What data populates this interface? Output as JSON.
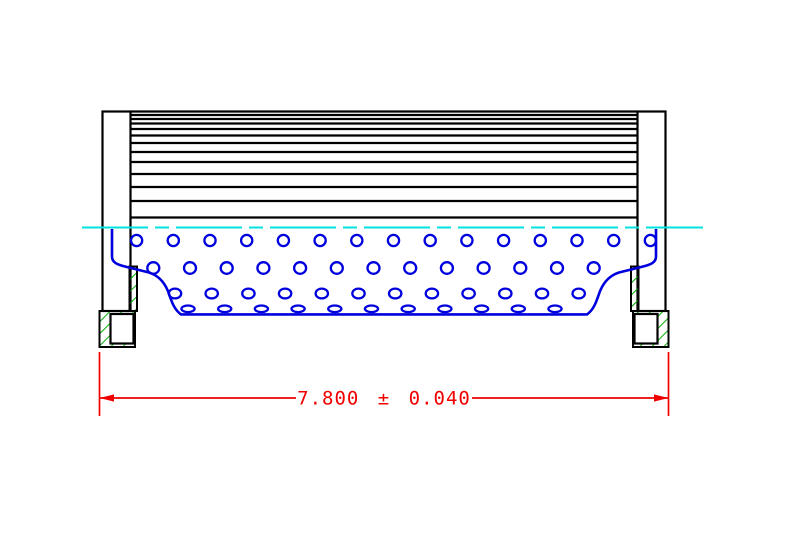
{
  "drawing": {
    "type": "technical-cad-cross-section",
    "subject": "filter-element-side-section-view",
    "dimension": {
      "label": "7.800 ± 0.040",
      "nominal": "7.800",
      "tolerance": "0.040"
    },
    "colors": {
      "black": "#000000",
      "blue": "#0000DE",
      "cyan": "#00E1E1",
      "green": "#00AE00",
      "red": "#F10000",
      "bg": "#FFFFFF"
    },
    "pleat_lines": {
      "x1": 130.5,
      "x2": 637.5,
      "ys": [
        111.5,
        115,
        119,
        123.5,
        129,
        135.5,
        143,
        152,
        162,
        174,
        187,
        201,
        217.5
      ]
    },
    "hole_rows": [
      {
        "y": 240.5,
        "rx": 5.6,
        "ry": 5.6,
        "x_start": 136.6,
        "spacing": 36.7,
        "count": 15
      },
      {
        "y": 268.0,
        "rx": 6.0,
        "ry": 5.8,
        "x_start": 153.3,
        "spacing": 36.7,
        "count": 13
      },
      {
        "y": 293.5,
        "rx": 6.2,
        "ry": 4.9,
        "x_start": 175.0,
        "spacing": 36.7,
        "count": 12
      },
      {
        "y": 308.8,
        "rx": 6.6,
        "ry": 3.3,
        "x_start": 188.0,
        "spacing": 36.7,
        "count": 11
      }
    ],
    "centerline": {
      "y": 227.5,
      "x1": 82,
      "x2": 703,
      "dash": "66 7 14 7"
    }
  }
}
